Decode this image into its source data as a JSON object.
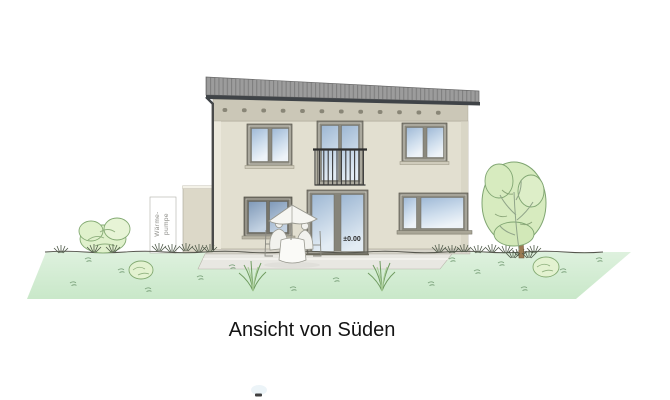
{
  "drawing": {
    "caption": "Ansicht von Süden",
    "level_label": "±0.00",
    "sign_line1": "Wärme-",
    "sign_line2": "pumpe"
  },
  "colors": {
    "background": "#ffffff",
    "roof": "#9c9c9c",
    "roof_stripe": "#7f7f7f",
    "eave_shadow": "#3f4347",
    "frieze_band": "#cbc7b7",
    "facade": "#e2dfd0",
    "annex": "#dcd8c8",
    "window_frame": "#8b897e",
    "glass_top": "#9fb9d6",
    "glass_bottom": "#eef3f8",
    "railing": "#2e2e2e",
    "lawn": "#d4eed4",
    "terrace": "#e8e7e2",
    "tree_foliage": "#d7ebbf",
    "tree_outline": "#7fa571",
    "trunk": "#9b7a52",
    "caption_text": "#141414"
  }
}
